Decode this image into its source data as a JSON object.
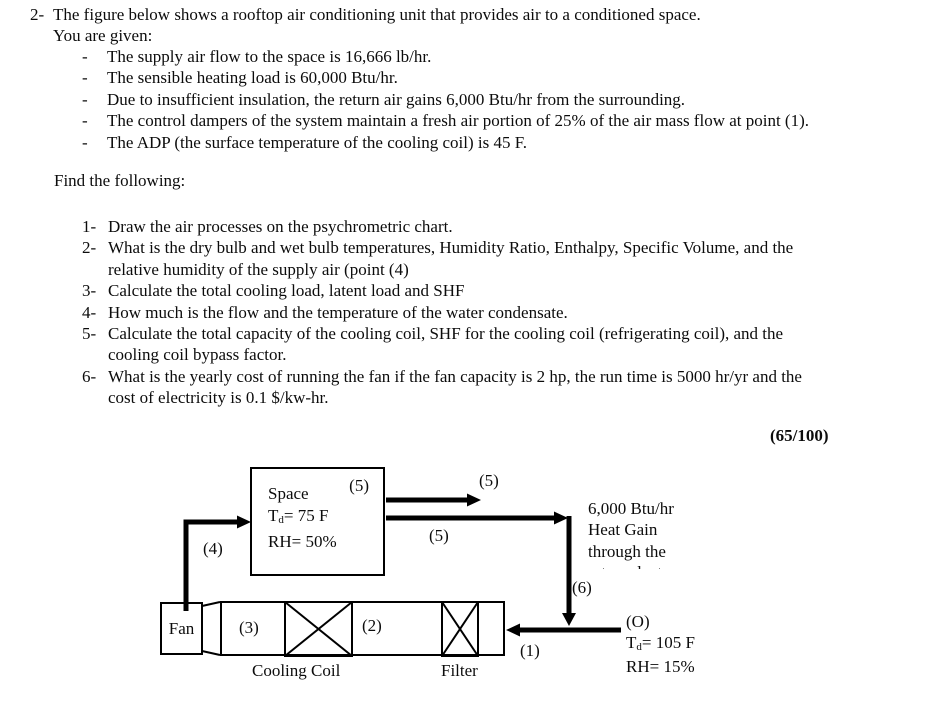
{
  "problem": {
    "number": "2-",
    "intro_lines": [
      "The figure below shows a rooftop air conditioning unit that provides air to a conditioned space.",
      "You are given:"
    ],
    "givens": [
      {
        "dash": "-",
        "text": "The supply air flow to the space is 16,666 lb/hr."
      },
      {
        "dash": "-",
        "text": "The sensible heating load is 60,000 Btu/hr."
      },
      {
        "dash": "-",
        "text": "Due to insufficient insulation, the return air gains 6,000 Btu/hr from the surrounding."
      },
      {
        "dash": "-",
        "text": "The control dampers of the system maintain a fresh air portion of 25% of the air mass flow at point (1)."
      },
      {
        "dash": "-",
        "text": "The ADP (the surface temperature of the cooling coil) is 45 F."
      }
    ],
    "find_heading": "Find the following:",
    "tasks": [
      {
        "num": "1-",
        "lines": [
          "Draw the air processes on the psychrometric chart."
        ]
      },
      {
        "num": "2-",
        "lines": [
          "What is the dry bulb and wet bulb temperatures, Humidity Ratio, Enthalpy, Specific Volume, and the",
          "relative humidity of the supply air (point (4)"
        ]
      },
      {
        "num": "3-",
        "lines": [
          "Calculate the total cooling load, latent load and SHF"
        ]
      },
      {
        "num": "4-",
        "lines": [
          "How much is the flow and the temperature of the water condensate."
        ]
      },
      {
        "num": "5-",
        "lines": [
          "Calculate the total capacity of the cooling coil, SHF for the cooling coil (refrigerating coil), and the",
          "cooling coil bypass factor."
        ]
      },
      {
        "num": "6-",
        "lines": [
          "What is the yearly cost of running the fan if the fan capacity is 2 hp, the run time is 5000 hr/yr and the",
          "cost of electricity is 0.1 $/kw-hr."
        ]
      }
    ],
    "score": "(65/100)"
  },
  "diagram": {
    "space": {
      "point": "(5)",
      "name": "Space",
      "t_prefix": "T",
      "t_sub": "d",
      "t_rest": "= 75 F",
      "rh": "RH= 50%"
    },
    "fan_label": "Fan",
    "cooling_coil_label": "Cooling Coil",
    "filter_label": "Filter",
    "point_labels": {
      "p1": "(1)",
      "p2": "(2)",
      "p3": "(3)",
      "p4": "(4)",
      "p5_top": "(5)",
      "p5_mid": "(5)",
      "p6": "(6)"
    },
    "heat_gain": {
      "line1": "6,000 Btu/hr",
      "line2": "Heat Gain",
      "line3": "through the",
      "line4_clipped": "return duct"
    },
    "outdoor": {
      "point": "(O)",
      "t_prefix": "T",
      "t_sub": "d",
      "t_rest": "= 105 F",
      "rh": "RH= 15%"
    },
    "line_color": "#000000"
  }
}
